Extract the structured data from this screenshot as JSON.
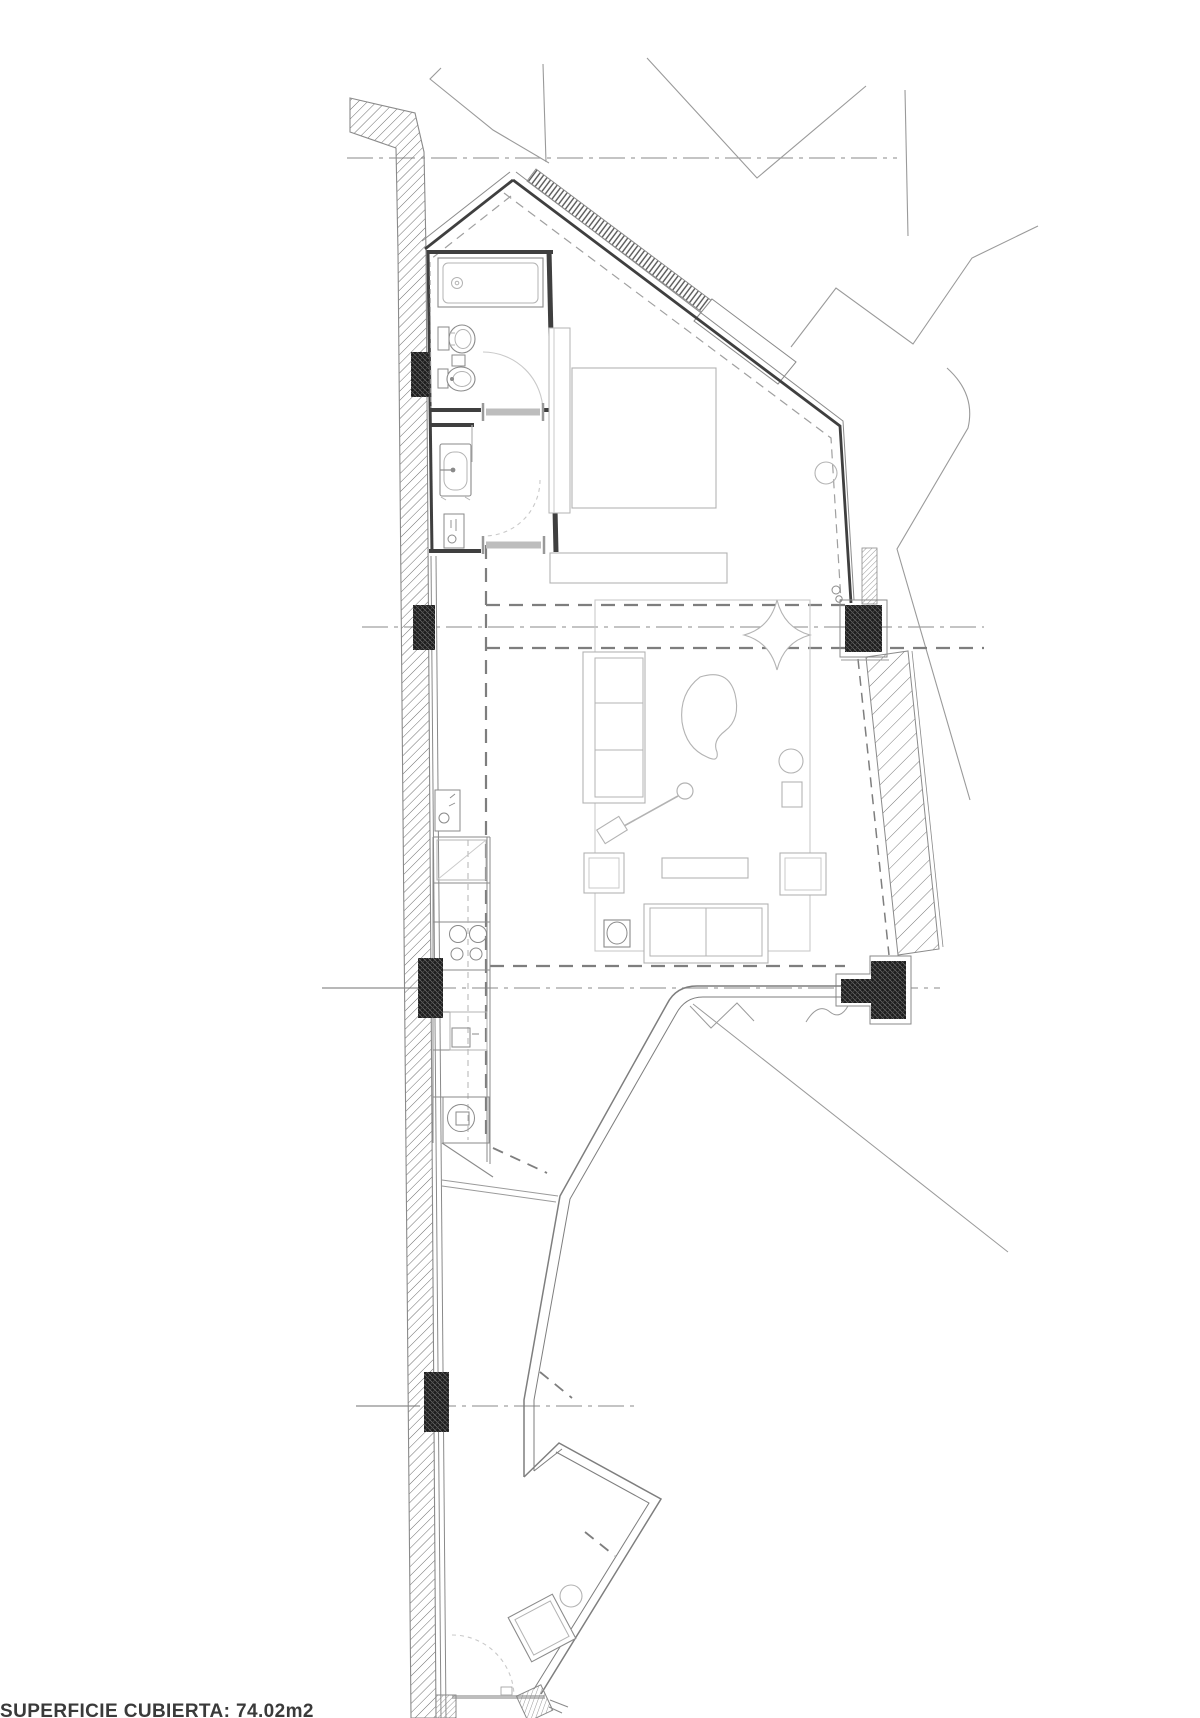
{
  "plan": {
    "footer": {
      "area_label": "SUPERFICIE CUBIERTA: 74.02m2"
    }
  },
  "colors": {
    "paper": "#ffffff",
    "wall_dark": "#3f3f3f",
    "line_med": "#8a8a8a",
    "line_light": "#b3b3b3",
    "line_faint": "#c9c9c9",
    "dash_gray": "#7e7e7e",
    "center_gray": "#a0a0a0",
    "neighbor_gray": "#9a9a9a",
    "leaf_gray": "#bdbdbd",
    "cap_gray": "#999999",
    "column_fill": "#1d1d1d"
  }
}
